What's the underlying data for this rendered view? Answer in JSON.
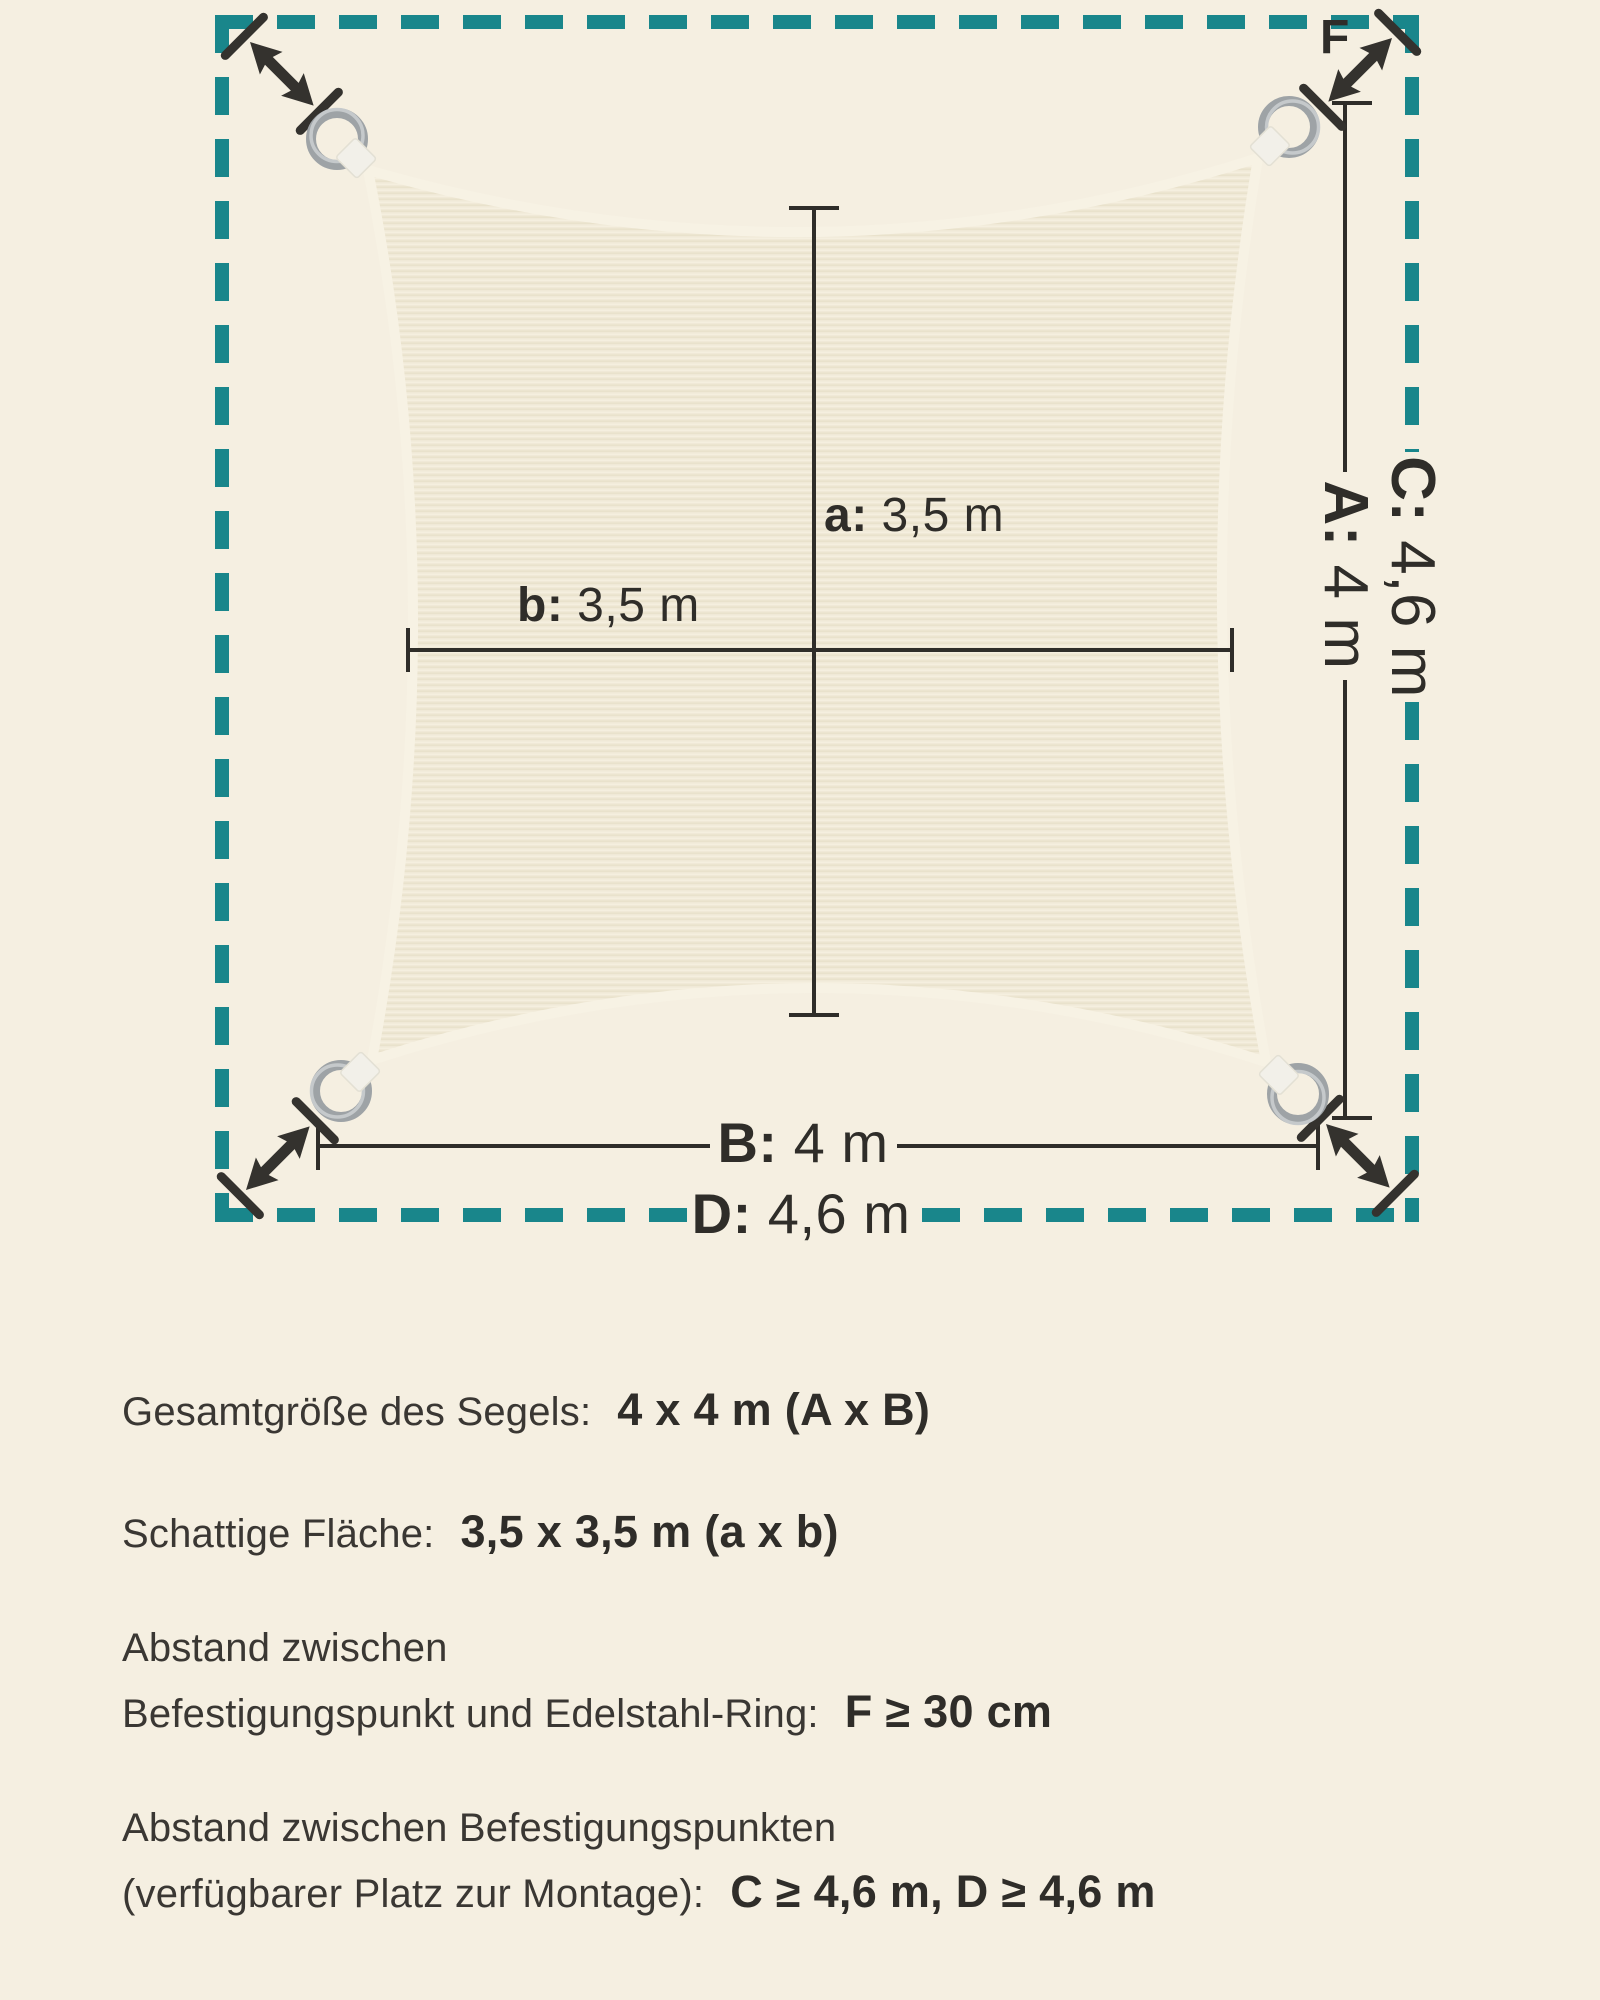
{
  "diagram": {
    "labels": {
      "a": {
        "key": "a:",
        "value": "3,5 m"
      },
      "b": {
        "key": "b:",
        "value": "3,5 m"
      },
      "A": {
        "key": "A:",
        "value": "4 m"
      },
      "B": {
        "key": "B:",
        "value": "4 m"
      },
      "C": {
        "key": "C:",
        "value": "4,6 m"
      },
      "D": {
        "key": "D:",
        "value": "4,6 m"
      },
      "F": "F"
    },
    "colors": {
      "background": "#f5efe1",
      "boundary_teal": "#19868b",
      "dimension_line": "#2f2d29",
      "fabric": "#f0e9d7",
      "fabric_hem": "#f7f2e4",
      "ring_metal": "#a7acae",
      "strap": "#f2f0e9"
    }
  },
  "specs": {
    "total_size": {
      "label": "Gesamtgröße des Segels:",
      "value": "4 x 4 m (A x B)"
    },
    "shaded_area": {
      "label": "Schattige Fläche:",
      "value": "3,5 x 3,5 m (a x b)"
    },
    "ring_distance": {
      "label_line1": "Abstand zwischen",
      "label_line2": "Befestigungspunkt und Edelstahl-Ring:",
      "value": "F ≥ 30 cm"
    },
    "mount_distance": {
      "label_line1": "Abstand zwischen Befestigungspunkten",
      "label_line2": "(verfügbarer Platz zur Montage):",
      "value": "C ≥ 4,6 m, D ≥ 4,6 m"
    }
  }
}
